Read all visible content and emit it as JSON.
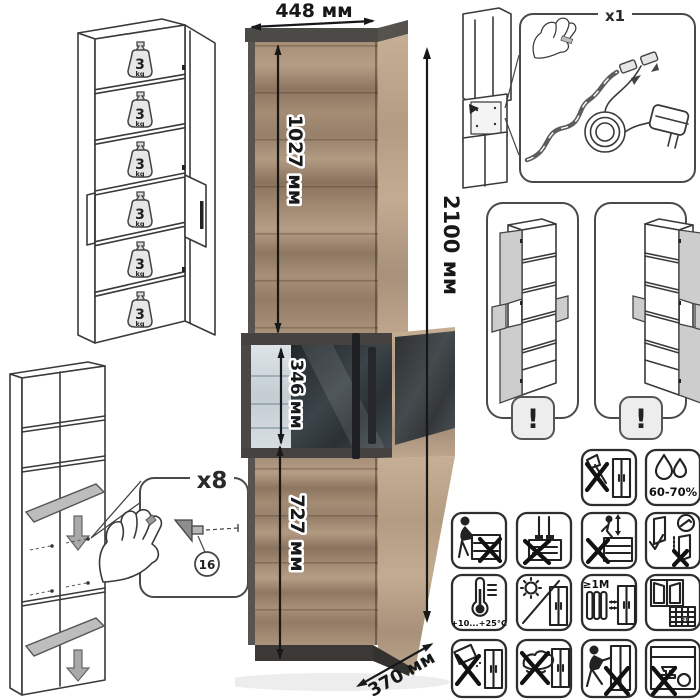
{
  "dimensions": {
    "width_label": "448 мм",
    "height_label": "2100 мм",
    "depth_label": "370 мм",
    "upper_door_label": "1027 мм",
    "display_section_label": "346 мм",
    "lower_door_label": "727 мм"
  },
  "shelf_load": {
    "value": "3",
    "unit": "kg"
  },
  "led_kit": {
    "qty_label": "x1"
  },
  "shelf_supports": {
    "qty_label": "x8",
    "part_id": "16"
  },
  "door_variants": {
    "warning_mark": "!"
  },
  "care": {
    "humidity": "60-70%",
    "temperature_range": "+10...+25°C",
    "radiator_distance": "≥1М",
    "airing_day": "21"
  },
  "colors": {
    "wood_front": "#a08872",
    "wood_side": "#c0a98f",
    "frame_dark": "#4c4a47",
    "glass_dark": "#2e3438",
    "glass_light": "#cfd8dc",
    "lineart": "#3a3a3a",
    "dimension_text": "#17181a"
  }
}
